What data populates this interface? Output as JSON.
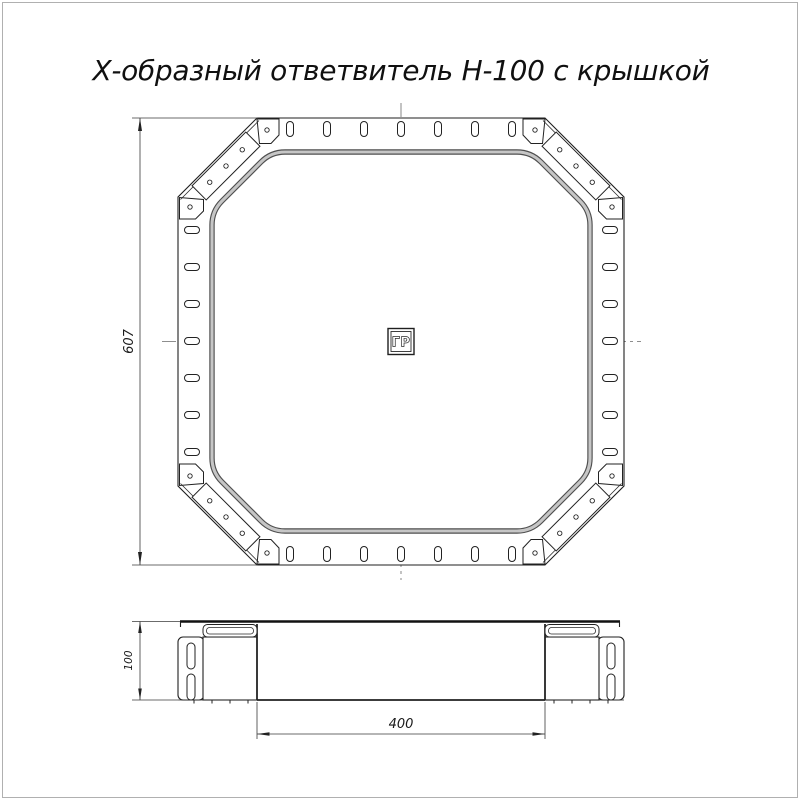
{
  "title": "Х-образный ответвитель Н-100 с крышкой",
  "top_view": {
    "name": "top view of X-branch with cover",
    "center_marker_label": "ГР",
    "height_dim": "607"
  },
  "side_view": {
    "name": "front elevation of X-branch",
    "height_dim": "100",
    "width_dim": "400"
  },
  "colors": {
    "line": "#1f1f1f",
    "cover_edge": "#4f4f4f",
    "cover_core": "#c6c6c6",
    "dimension": "#3a3a3a",
    "page_border": "#b0b0b0",
    "background": "#ffffff"
  }
}
